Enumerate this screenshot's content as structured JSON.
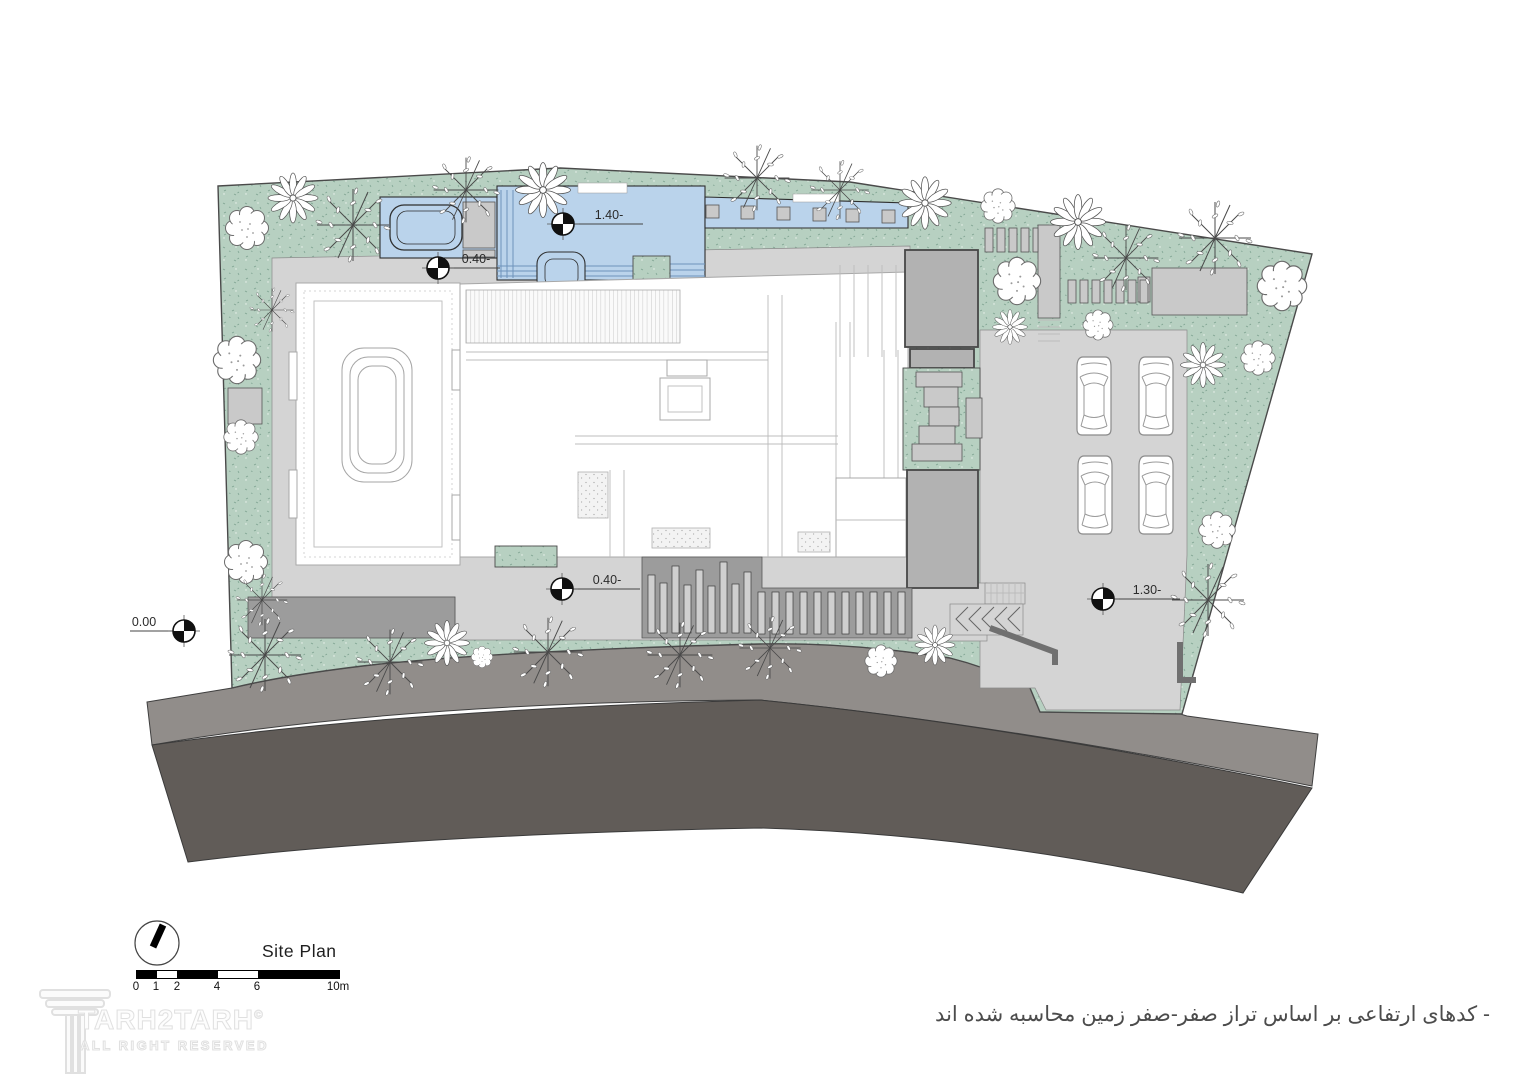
{
  "drawing": {
    "title": "Site Plan",
    "scale_ticks": [
      "0",
      "1",
      "2",
      "4",
      "6",
      "10m"
    ],
    "markers": [
      {
        "id": "street-level",
        "label": "0.00"
      },
      {
        "id": "pool-level",
        "label": "1.40-"
      },
      {
        "id": "pool-deck-level",
        "label": "0.40-"
      },
      {
        "id": "yard-level",
        "label": "0.40-"
      },
      {
        "id": "parking-level",
        "label": "1.30-"
      }
    ]
  },
  "watermark": {
    "brand": "TARH2TARH",
    "copyright": "©",
    "rights": "ALL RIGHT RESERVED"
  },
  "note": "- کدهای ارتفاعی بر اساس تراز صفر-صفر زمین محاسبه شده اند",
  "colors": {
    "grass": "#b7d0c1",
    "grass_fleck": "#7fa392",
    "pool": "#bad3eb",
    "paving": "#d4d4d4",
    "sidewalk": "#918d8a",
    "road": "#615c58",
    "wall": "#9c9c9c",
    "block": "#b2b2b2",
    "line": "#4a4a4a"
  }
}
